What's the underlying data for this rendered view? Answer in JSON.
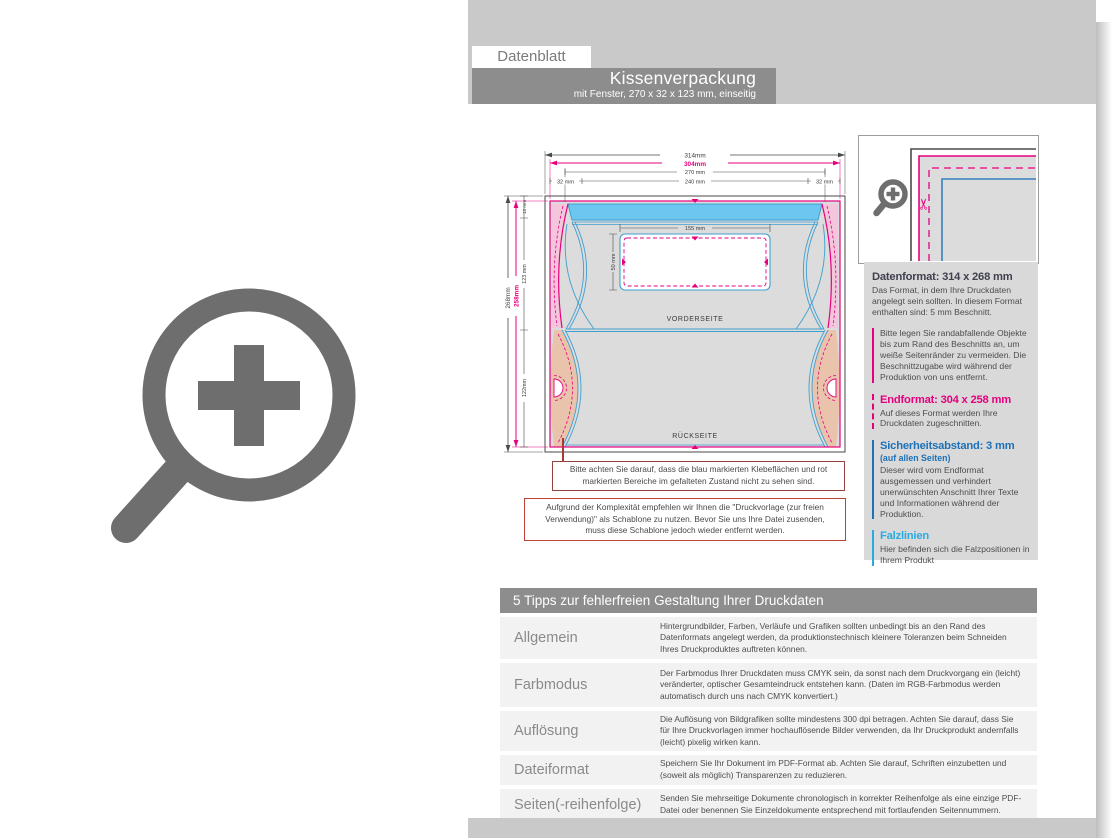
{
  "header": {
    "tag": "Datenblatt",
    "title": "Kissenverpackung",
    "subtitle": "mit Fenster, 270 x 32 x 123 mm, einseitig"
  },
  "diagram": {
    "dims": {
      "w_total": "314mm",
      "w_end": "304mm",
      "w_inner": "270 mm",
      "w_left": "32 mm",
      "w_mid": "240 mm",
      "w_right": "32 mm",
      "h_total": "268mm",
      "h_end": "258mm",
      "h_top": "13 mm",
      "h_front": "123 mm",
      "h_back": "122mm",
      "window_w": "155 mm",
      "window_h": "50 mm"
    },
    "front_label": "VORDERSEITE",
    "back_label": "RÜCKSEITE",
    "note1": "Bitte achten Sie darauf, dass die blau markierten Klebeflächen und rot markierten Bereiche im gefalteten Zustand nicht zu sehen sind.",
    "note2": "Aufgrund der Komplexität empfehlen wir Ihnen die \"Druckvorlage (zur freien Verwendung)\" als Schablone zu nutzen. Bevor Sie uns Ihre Datei zusenden, muss diese Schablone jedoch wieder entfernt werden."
  },
  "info_panel": {
    "sections": [
      {
        "title": "Datenformat: 314 x 268 mm",
        "body": "Das Format, in dem Ihre Druckdaten angelegt sein sollten. In diesem Format enthalten sind: 5 mm Beschnitt.",
        "note": "Bitte legen Sie randabfallende Objekte bis zum Rand des Beschnitts an, um weiße Seitenränder zu vermeiden. Die Beschnittzugabe wird während der Produktion von uns entfernt."
      },
      {
        "title": "Endformat: 304 x 258 mm",
        "body": "Auf dieses Format werden Ihre Druckdaten zugeschnitten."
      },
      {
        "title": "Sicherheitsabstand: 3 mm",
        "subtitle": "(auf allen Seiten)",
        "body": "Dieser wird vom Endformat ausgemessen und verhindert unerwünschten Anschnitt Ihrer Texte und Informationen während der Produktion."
      },
      {
        "title": "Falzlinien",
        "body": "Hier befinden sich die Falzpositionen in Ihrem Produkt"
      }
    ]
  },
  "tips": {
    "header": "5 Tipps zur fehlerfreien Gestaltung Ihrer Druckdaten",
    "rows": [
      {
        "label": "Allgemein",
        "text": "Hintergrundbilder, Farben, Verläufe und Grafiken sollten unbedingt bis an den Rand des Datenformats angelegt werden, da produktionstechnisch kleinere Toleranzen beim Schneiden Ihres Druckproduktes auftreten können."
      },
      {
        "label": "Farbmodus",
        "text": "Der Farbmodus Ihrer Druckdaten muss CMYK sein, da sonst nach dem Druckvorgang ein (leicht) veränderter, optischer Gesamteindruck entstehen kann. (Daten im RGB-Farbmodus werden automatisch durch uns nach CMYK konvertiert.)"
      },
      {
        "label": "Auflösung",
        "text": "Die Auflösung von Bildgrafiken sollte mindestens 300 dpi betragen. Achten Sie darauf, dass Sie für Ihre Druckvorlagen immer hochauflösende Bilder verwenden, da Ihr Druckprodukt andernfalls (leicht) pixelig wirken kann."
      },
      {
        "label": "Dateiformat",
        "text": "Speichern Sie Ihr Dokument im PDF-Format ab. Achten Sie darauf, Schriften einzubetten und (soweit als möglich) Transparenzen zu reduzieren."
      },
      {
        "label": "Seiten(-reihenfolge)",
        "text": "Senden Sie mehrseitige Dokumente chronologisch in korrekter Reihenfolge als eine einzige PDF-Datei oder benennen Sie Einzeldokumente entsprechend mit fortlaufenden Seitennummern."
      }
    ]
  },
  "icons": {
    "scissors_glyph": "✂"
  },
  "colors": {
    "accent_magenta": "#e6007e",
    "accent_blue": "#1d71b8",
    "accent_cyan": "#29abe2",
    "glue_blue_fill": "#6cc6ef",
    "glue_salmon_fill": "#e9c3ab",
    "band_gray": "#c9c9c9",
    "bar_gray": "#8d8d8d"
  }
}
